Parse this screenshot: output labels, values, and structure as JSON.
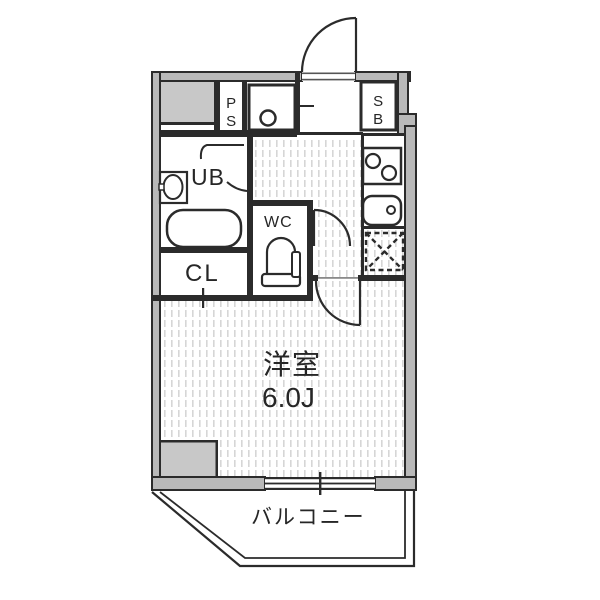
{
  "floorplan": {
    "labels": {
      "ps": "PS",
      "sb": "SB",
      "ub": "UB",
      "wc": "WC",
      "cl": "CL",
      "room_name": "洋室",
      "room_size": "6.0J",
      "balcony": "バルコニー"
    },
    "fixtures": [
      "entrance-door",
      "washing-machine-pan",
      "shoe-box",
      "washbasin",
      "bathtub",
      "unit-bath-folding-door",
      "toilet",
      "wc-door",
      "two-burner-stove",
      "kitchen-sink",
      "refrigerator-space",
      "room-door",
      "closet-door-mark",
      "sliding-window",
      "balcony-parapet"
    ],
    "colors": {
      "wall_line": "#2b2b2b",
      "wall_core": "#b9b9b9",
      "solid_area": "#c8c8c8",
      "floor_hatch": "#d6d6d6",
      "background": "#ffffff",
      "text": "#262626"
    }
  }
}
